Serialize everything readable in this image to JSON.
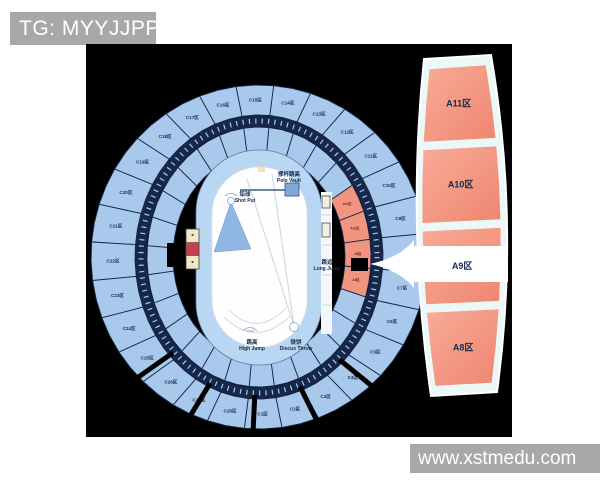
{
  "header": {
    "tag": "TG: MYYJJPP"
  },
  "watermark": {
    "url": "www.xstmedu.com"
  },
  "colors": {
    "chip_bg": "#a8a8a8",
    "map_bg": "#000000",
    "section_blue": "#a9c9ec",
    "divider_navy": "#16284a",
    "track_blue": "#b9d6f2",
    "infield_white": "#fefefe",
    "zone_red": "#f29580",
    "zone_red_light": "#f8ab97",
    "zone_red_deep": "#ef8670",
    "panel_border": "#ecf8f8",
    "label_navy": "#16284a",
    "marker_red": "#c2414e",
    "marker_cream": "#f0e8c6",
    "arrow_white": "#ffffff"
  },
  "stadium": {
    "outer_sections": [
      "C1区",
      "C2区",
      "C3区",
      "C4区",
      "C5区",
      "C6区",
      "C7区",
      "C8区",
      "C9区",
      "C10区",
      "C11区",
      "C12区",
      "C13区",
      "C14区",
      "C15区",
      "C16区",
      "C17区",
      "C18区",
      "C19区",
      "C20区",
      "C21区",
      "C22区",
      "C23区",
      "C24区",
      "C25区",
      "C26区",
      "C27区",
      "C28区"
    ],
    "red_sections": [
      {
        "label": "A8区"
      },
      {
        "label": "A9区"
      },
      {
        "label": "A10区"
      },
      {
        "label": "A11区"
      }
    ],
    "field_events": [
      {
        "id": "pole-vault",
        "zh": "撑杆跳高",
        "en": "Pole Vault"
      },
      {
        "id": "shot-put",
        "zh": "铅球",
        "en": "Shot Put"
      },
      {
        "id": "long-jump",
        "zh": "跳远",
        "en": "Long Jump"
      },
      {
        "id": "high-jump",
        "zh": "跳高",
        "en": "High Jump"
      },
      {
        "id": "discus-throw",
        "zh": "铁饼",
        "en": "Discus Throw"
      }
    ]
  },
  "zoom_panel": {
    "zones": [
      {
        "label": "A11区"
      },
      {
        "label": "A10区"
      },
      {
        "label": "A9区"
      },
      {
        "label": "A8区"
      }
    ]
  }
}
